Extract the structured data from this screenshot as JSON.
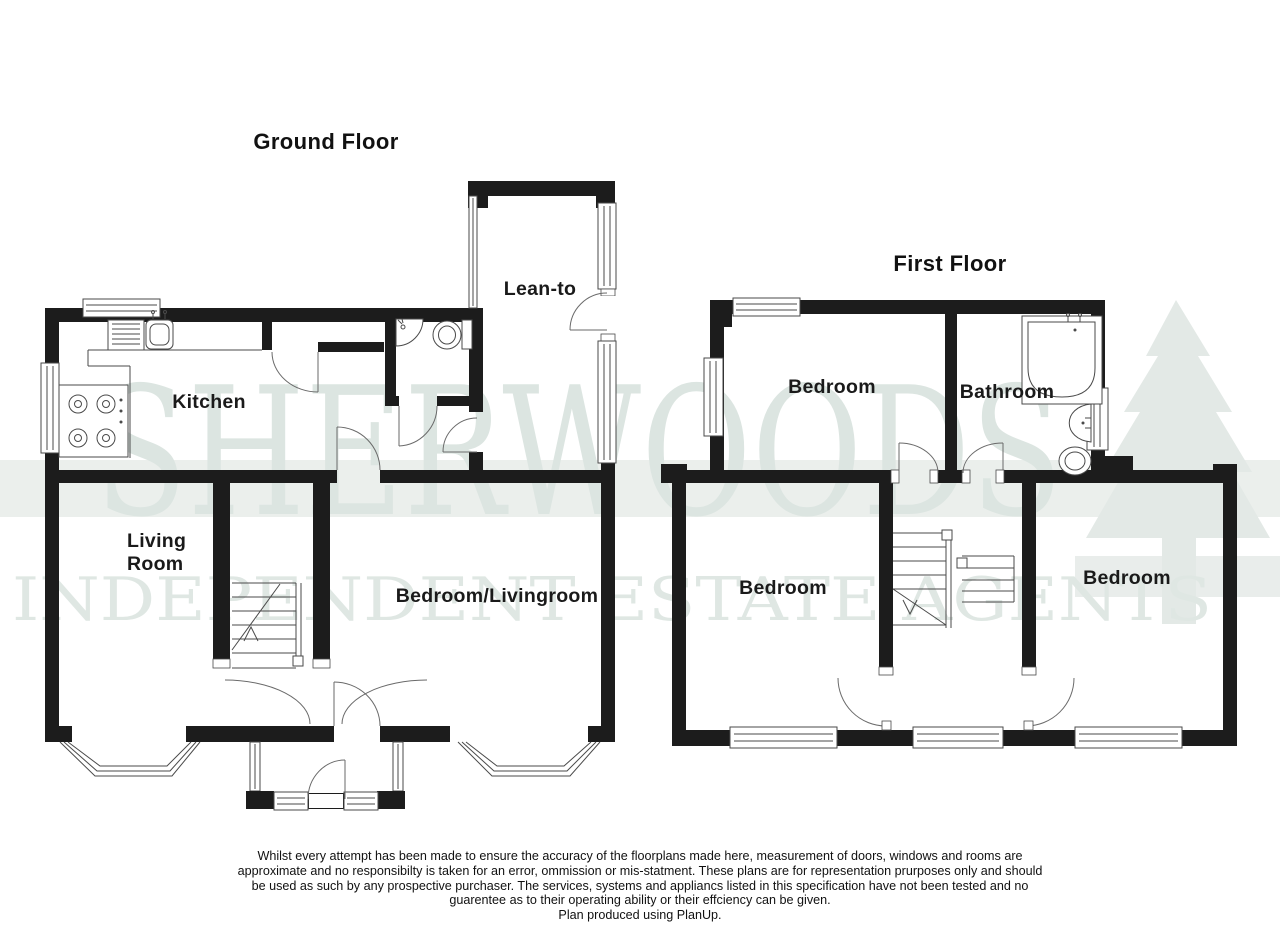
{
  "page": {
    "width": 1280,
    "height": 931,
    "background": "#ffffff"
  },
  "watermark": {
    "brand": "SHERWOODS",
    "tagline": "INDEPENDENT ESTATE AGENTS",
    "text_color": "#dce5e1",
    "band_color": "#ebefec",
    "tree_color": "#e3e9e6",
    "tree_icon": "pine-tree-logo"
  },
  "ground_floor": {
    "title": "Ground Floor",
    "rooms": {
      "kitchen": "Kitchen",
      "lean_to": "Lean-to",
      "living_line1": "Living",
      "living_line2": "Room",
      "bedroom_livingroom": "Bedroom/Livingroom"
    }
  },
  "first_floor": {
    "title": "First Floor",
    "rooms": {
      "bedroom_top": "Bedroom",
      "bathroom": "Bathroom",
      "bedroom_left": "Bedroom",
      "bedroom_right": "Bedroom"
    }
  },
  "footer": {
    "disclaimer_line1": "Whilst every attempt has been made to ensure the accuracy of the floorplans made here, measurement of doors, windows and rooms are",
    "disclaimer_line2": "approximate and no responsibilty is taken for an error, ommission or mis-statment. These plans are for representation prurposes only and should",
    "disclaimer_line3": "be used as such by any prospective purchaser. The services, systems and appliancs listed in this specification have not been tested and no",
    "disclaimer_line4": "guarentee as to their operating ability or their effciency can be given.",
    "credit": "Plan produced using PlanUp."
  },
  "colors": {
    "wall": "#1c1c1c",
    "thin_line": "#4a4a4a",
    "label": "#1a1a1a"
  }
}
